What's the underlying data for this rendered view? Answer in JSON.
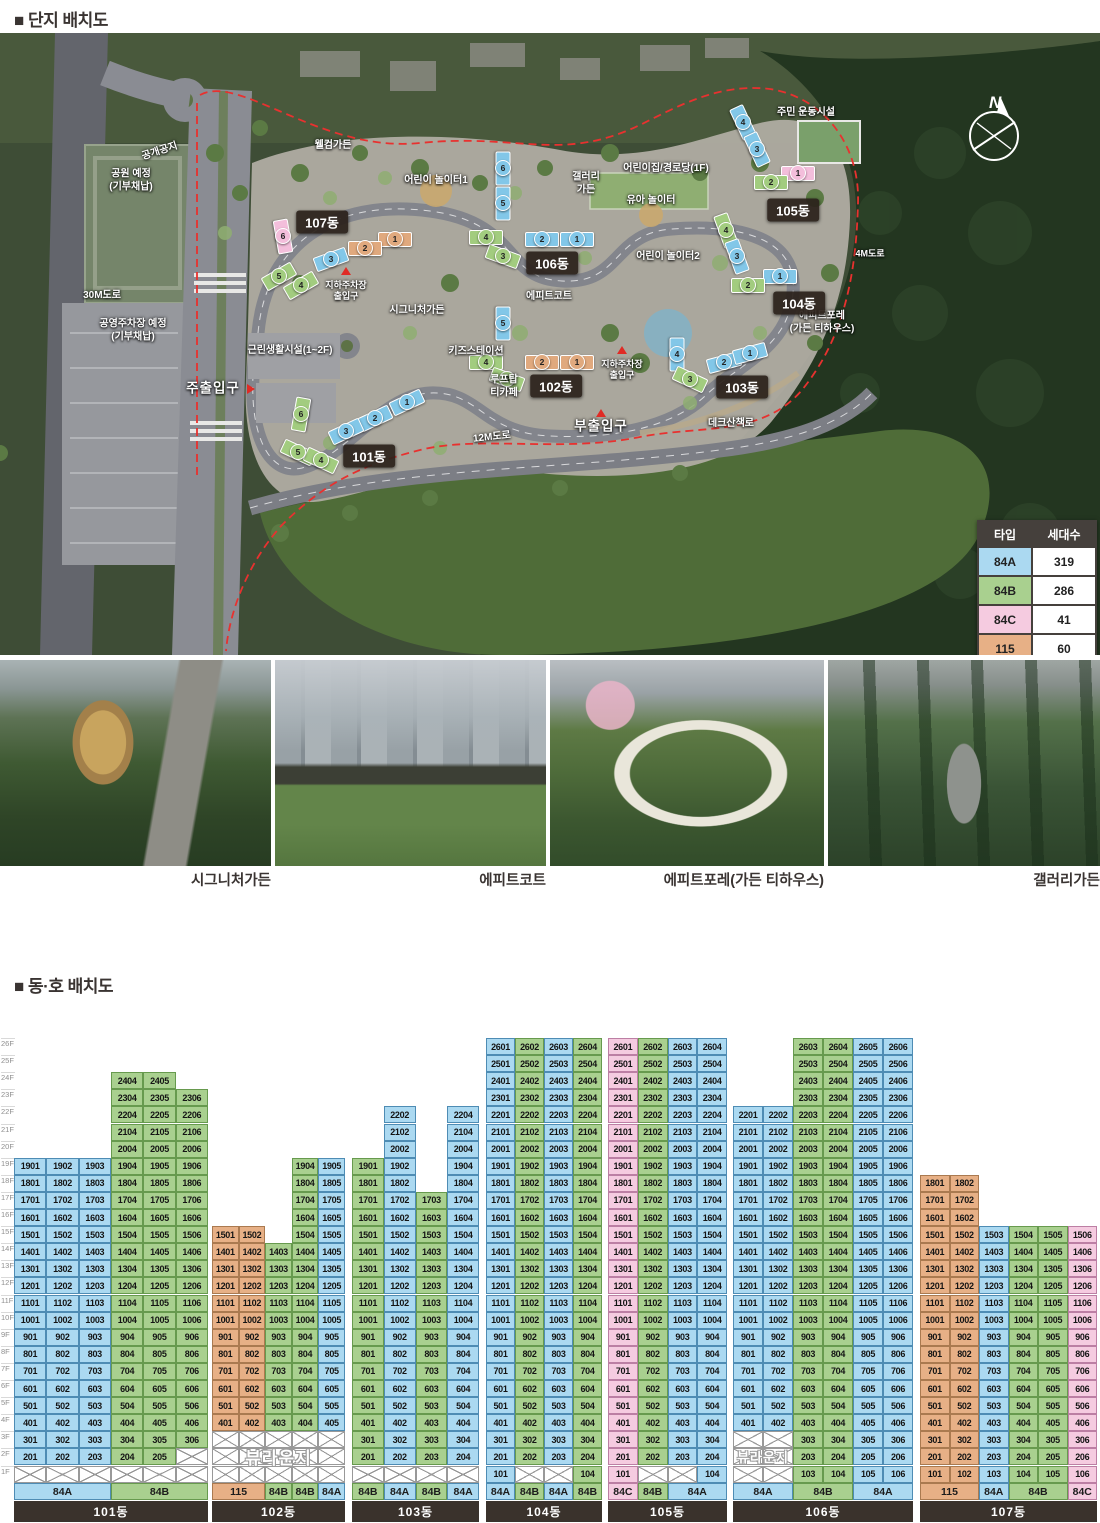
{
  "titles": {
    "site_plan": "■ 단지 배치도",
    "unit_layout": "■ 동·호 배치도"
  },
  "legend": {
    "col_type": "타입",
    "col_count": "세대수",
    "rows": [
      [
        "84A",
        "319"
      ],
      [
        "84B",
        "286"
      ],
      [
        "84C",
        "41"
      ],
      [
        "115",
        "60"
      ]
    ],
    "total": "총 706세대"
  },
  "type_colors": {
    "84A": {
      "fill": "#abd9f1",
      "edge": "#4e8cb4",
      "map": "#82c7e8"
    },
    "84B": {
      "fill": "#a9d08f",
      "edge": "#679a4e",
      "map": "#a2cc7f"
    },
    "84C": {
      "fill": "#f5cbe0",
      "edge": "#bc7fa4",
      "map": "#f3bedb"
    },
    "115": {
      "fill": "#e7b086",
      "edge": "#aa7a50",
      "map": "#e0a97e"
    }
  },
  "map": {
    "compass": "N",
    "labels": [
      {
        "t": "공개공지",
        "x": 160,
        "y": 152,
        "r": -18
      },
      {
        "t": "웰컴가든",
        "x": 333,
        "y": 146
      },
      {
        "t": "어린이 놀이터1",
        "x": 436,
        "y": 181
      },
      {
        "t": "갤러리\n가든",
        "x": 586,
        "y": 184
      },
      {
        "t": "어린이집/경로당(1F)",
        "x": 666,
        "y": 169
      },
      {
        "t": "유아 놀이터",
        "x": 651,
        "y": 201
      },
      {
        "t": "주민 운동시설",
        "x": 806,
        "y": 113
      },
      {
        "t": "4M도로",
        "x": 870,
        "y": 254,
        "s": 9
      },
      {
        "t": "어린이 놀이터2",
        "x": 668,
        "y": 257
      },
      {
        "t": "에피트코트",
        "x": 549,
        "y": 297
      },
      {
        "t": "에피트포레\n(가든 티하우스)",
        "x": 822,
        "y": 323
      },
      {
        "t": "시그니처가든",
        "x": 417,
        "y": 311
      },
      {
        "t": "지하주차장\n출입구",
        "x": 346,
        "y": 291,
        "s": 9,
        "marker": "up"
      },
      {
        "t": "지하주차장\n출입구",
        "x": 622,
        "y": 370,
        "s": 9,
        "marker": "up"
      },
      {
        "t": "공원 예정\n(기부채납)",
        "x": 131,
        "y": 181
      },
      {
        "t": "30M도로",
        "x": 102,
        "y": 296
      },
      {
        "t": "공영주차장 예정\n(기부채납)",
        "x": 133,
        "y": 331
      },
      {
        "t": "근린생활시설(1~2F)",
        "x": 290,
        "y": 351
      },
      {
        "t": "키즈스테이션",
        "x": 476,
        "y": 352
      },
      {
        "t": "루프탑\n티카페",
        "x": 504,
        "y": 387
      },
      {
        "t": "주출입구",
        "x": 213,
        "y": 389,
        "big": true,
        "marker": "right"
      },
      {
        "t": "12M도로",
        "x": 492,
        "y": 438,
        "r": -6
      },
      {
        "t": "부출입구",
        "x": 601,
        "y": 427,
        "big": true,
        "marker": "up"
      },
      {
        "t": "데크산책로",
        "x": 731,
        "y": 424
      }
    ],
    "chips": [
      {
        "t": "101동",
        "x": 369,
        "y": 456
      },
      {
        "t": "102동",
        "x": 556,
        "y": 386
      },
      {
        "t": "103동",
        "x": 742,
        "y": 387
      },
      {
        "t": "104동",
        "x": 799,
        "y": 303
      },
      {
        "t": "105동",
        "x": 793,
        "y": 210
      },
      {
        "t": "106동",
        "x": 552,
        "y": 263
      },
      {
        "t": "107동",
        "x": 322,
        "y": 222
      }
    ],
    "units": [
      {
        "n": "6",
        "t": "84B",
        "x": 300,
        "y": 413,
        "a": -80
      },
      {
        "n": "1",
        "t": "84A",
        "x": 406,
        "y": 401,
        "a": -25
      },
      {
        "n": "2",
        "t": "84A",
        "x": 374,
        "y": 417,
        "a": -25
      },
      {
        "n": "3",
        "t": "84A",
        "x": 345,
        "y": 430,
        "a": -25
      },
      {
        "n": "5",
        "t": "84B",
        "x": 297,
        "y": 451,
        "a": 25
      },
      {
        "n": "4",
        "t": "84B",
        "x": 320,
        "y": 459,
        "a": 25
      },
      {
        "n": "5",
        "t": "84A",
        "x": 502,
        "y": 322,
        "a": 90
      },
      {
        "n": "4",
        "t": "84B",
        "x": 485,
        "y": 361,
        "a": 0
      },
      {
        "n": "2",
        "t": "115",
        "x": 541,
        "y": 361,
        "a": 0
      },
      {
        "n": "1",
        "t": "115",
        "x": 576,
        "y": 361,
        "a": 0
      },
      {
        "n": "3",
        "t": "84B",
        "x": 506,
        "y": 378,
        "a": 20
      },
      {
        "n": "4",
        "t": "84A",
        "x": 676,
        "y": 353,
        "a": 90
      },
      {
        "n": "2",
        "t": "84A",
        "x": 723,
        "y": 361,
        "a": -15
      },
      {
        "n": "1",
        "t": "84A",
        "x": 749,
        "y": 352,
        "a": -15
      },
      {
        "n": "3",
        "t": "84B",
        "x": 689,
        "y": 378,
        "a": 25
      },
      {
        "n": "4",
        "t": "84B",
        "x": 725,
        "y": 229,
        "a": 70
      },
      {
        "n": "3",
        "t": "84A",
        "x": 736,
        "y": 255,
        "a": 70
      },
      {
        "n": "1",
        "t": "84A",
        "x": 779,
        "y": 275,
        "a": 0
      },
      {
        "n": "2",
        "t": "84B",
        "x": 747,
        "y": 284,
        "a": 0
      },
      {
        "n": "4",
        "t": "84A",
        "x": 742,
        "y": 121,
        "a": 65
      },
      {
        "n": "3",
        "t": "84A",
        "x": 756,
        "y": 148,
        "a": 65
      },
      {
        "n": "1",
        "t": "84C",
        "x": 797,
        "y": 172,
        "a": 0
      },
      {
        "n": "2",
        "t": "84B",
        "x": 770,
        "y": 181,
        "a": 0
      },
      {
        "n": "6",
        "t": "84A",
        "x": 502,
        "y": 167,
        "a": 90
      },
      {
        "n": "5",
        "t": "84A",
        "x": 502,
        "y": 202,
        "a": 90
      },
      {
        "n": "4",
        "t": "84B",
        "x": 485,
        "y": 236,
        "a": 0
      },
      {
        "n": "2",
        "t": "84A",
        "x": 541,
        "y": 238,
        "a": 0
      },
      {
        "n": "1",
        "t": "84A",
        "x": 576,
        "y": 238,
        "a": 0
      },
      {
        "n": "3",
        "t": "84B",
        "x": 502,
        "y": 255,
        "a": 20
      },
      {
        "n": "6",
        "t": "84C",
        "x": 282,
        "y": 235,
        "a": 80
      },
      {
        "n": "1",
        "t": "115",
        "x": 394,
        "y": 238,
        "a": 0
      },
      {
        "n": "2",
        "t": "115",
        "x": 364,
        "y": 247,
        "a": 0
      },
      {
        "n": "3",
        "t": "84A",
        "x": 330,
        "y": 258,
        "a": -20
      },
      {
        "n": "5",
        "t": "84B",
        "x": 278,
        "y": 275,
        "a": -30
      },
      {
        "n": "4",
        "t": "84B",
        "x": 300,
        "y": 284,
        "a": -30
      }
    ]
  },
  "photos": [
    {
      "caption": "시그니처가든"
    },
    {
      "caption": "에피트코트"
    },
    {
      "caption": "에피트포레(가든 티하우스)"
    },
    {
      "caption": "갤러리가든"
    }
  ],
  "grid": {
    "floors_top": 26,
    "unit_number_rule": "floor*100 + line",
    "floor_labels": [
      "26F",
      "25F",
      "24F",
      "23F",
      "22F",
      "21F",
      "20F",
      "19F",
      "18F",
      "17F",
      "16F",
      "15F",
      "14F",
      "13F",
      "12F",
      "11F",
      "10F",
      "9F",
      "8F",
      "7F",
      "6F",
      "5F",
      "4F",
      "3F",
      "2F",
      "1F"
    ],
    "lounge_label": "뷰라운지",
    "buildings": [
      {
        "name": "101동",
        "x": 14,
        "w": 194,
        "cols": [
          {
            "line": 1,
            "t": "84A",
            "f": 2,
            "to": 19
          },
          {
            "line": 2,
            "t": "84A",
            "f": 2,
            "to": 19
          },
          {
            "line": 3,
            "t": "84A",
            "f": 2,
            "to": 19
          },
          {
            "line": 4,
            "t": "84B",
            "f": 2,
            "to": 24
          },
          {
            "line": 5,
            "t": "84B",
            "f": 2,
            "to": 24
          },
          {
            "line": 6,
            "t": "84B",
            "f": 3,
            "to": 23
          }
        ],
        "xmarks": [
          {
            "fl": 1,
            "cols": [
              1,
              2,
              3,
              4,
              5,
              6
            ]
          },
          {
            "fl": 2,
            "cols": [
              6
            ]
          }
        ],
        "footer": [
          {
            "l": "84A",
            "s": 3
          },
          {
            "l": "84B",
            "s": 3
          }
        ]
      },
      {
        "name": "102동",
        "x": 212,
        "w": 133,
        "cols": [
          {
            "line": 1,
            "t": "115",
            "f": 4,
            "to": 15
          },
          {
            "line": 2,
            "t": "115",
            "f": 4,
            "to": 15
          },
          {
            "line": 3,
            "t": "84B",
            "f": 4,
            "to": 14
          },
          {
            "line": 4,
            "t": "84B",
            "f": 4,
            "to": 19
          },
          {
            "line": 5,
            "t": "84A",
            "f": 4,
            "to": 19
          }
        ],
        "lounge": {
          "f1": 1,
          "f2": 3,
          "c1": 1,
          "c2": 5
        },
        "footer": [
          {
            "l": "115",
            "s": 2
          },
          {
            "l": "84B",
            "s": 1
          },
          {
            "l": "84B",
            "s": 1
          },
          {
            "l": "84A",
            "s": 1
          }
        ]
      },
      {
        "name": "103동",
        "x": 352,
        "w": 127,
        "cols": [
          {
            "line": 1,
            "t": "84B",
            "f": 2,
            "to": 19
          },
          {
            "line": 2,
            "t": "84A",
            "f": 2,
            "to": 22
          },
          {
            "line": 3,
            "t": "84B",
            "f": 2,
            "to": 17
          },
          {
            "line": 4,
            "t": "84A",
            "f": 2,
            "to": 22
          }
        ],
        "xmarks": [
          {
            "fl": 1,
            "cols": [
              1,
              2,
              3,
              4
            ]
          }
        ],
        "footer": [
          {
            "l": "84B",
            "s": 1
          },
          {
            "l": "84A",
            "s": 1
          },
          {
            "l": "84B",
            "s": 1
          },
          {
            "l": "84A",
            "s": 1
          }
        ]
      },
      {
        "name": "104동",
        "x": 486,
        "w": 116,
        "cols": [
          {
            "line": 1,
            "t": "84A",
            "f": 1,
            "to": 26
          },
          {
            "line": 2,
            "t": "84B",
            "f": 2,
            "to": 26
          },
          {
            "line": 3,
            "t": "84A",
            "f": 2,
            "to": 26
          },
          {
            "line": 4,
            "t": "84B",
            "f": 1,
            "to": 26
          }
        ],
        "xmarks": [
          {
            "fl": 1,
            "cols": [
              2,
              3
            ]
          }
        ],
        "footer": [
          {
            "l": "84A",
            "s": 1
          },
          {
            "l": "84B",
            "s": 1
          },
          {
            "l": "84A",
            "s": 1
          },
          {
            "l": "84B",
            "s": 1
          }
        ]
      },
      {
        "name": "105동",
        "x": 608,
        "w": 119,
        "cols": [
          {
            "line": 1,
            "t": "84C",
            "f": 1,
            "to": 26
          },
          {
            "line": 2,
            "t": "84B",
            "f": 2,
            "to": 26
          },
          {
            "line": 3,
            "t": "84A",
            "f": 2,
            "to": 26
          },
          {
            "line": 4,
            "t": "84A",
            "f": 1,
            "to": 26
          }
        ],
        "xmarks": [
          {
            "fl": 1,
            "cols": [
              2,
              3
            ]
          }
        ],
        "footer": [
          {
            "l": "84C",
            "s": 1
          },
          {
            "l": "84B",
            "s": 1
          },
          {
            "l": "84A",
            "s": 2
          }
        ]
      },
      {
        "name": "106동",
        "x": 733,
        "w": 180,
        "cols": [
          {
            "line": 1,
            "t": "84A",
            "f": 4,
            "to": 22
          },
          {
            "line": 2,
            "t": "84A",
            "f": 4,
            "to": 22
          },
          {
            "line": 3,
            "t": "84B",
            "f": 1,
            "to": 26
          },
          {
            "line": 4,
            "t": "84B",
            "f": 1,
            "to": 26
          },
          {
            "line": 5,
            "t": "84A",
            "f": 1,
            "to": 26
          },
          {
            "line": 6,
            "t": "84A",
            "f": 1,
            "to": 26
          }
        ],
        "lounge": {
          "f1": 1,
          "f2": 3,
          "c1": 1,
          "c2": 2
        },
        "footer": [
          {
            "l": "84A",
            "s": 2
          },
          {
            "l": "84B",
            "s": 2
          },
          {
            "l": "84A",
            "s": 2
          }
        ]
      },
      {
        "name": "107동",
        "x": 920,
        "w": 177,
        "cols": [
          {
            "line": 1,
            "t": "115",
            "f": 1,
            "to": 18
          },
          {
            "line": 2,
            "t": "115",
            "f": 1,
            "to": 18
          },
          {
            "line": 3,
            "t": "84A",
            "f": 1,
            "to": 15
          },
          {
            "line": 4,
            "t": "84B",
            "f": 1,
            "to": 15
          },
          {
            "line": 5,
            "t": "84B",
            "f": 1,
            "to": 15
          },
          {
            "line": 6,
            "t": "84C",
            "f": 1,
            "to": 15
          }
        ],
        "footer": [
          {
            "l": "115",
            "s": 2
          },
          {
            "l": "84A",
            "s": 1
          },
          {
            "l": "84B",
            "s": 2
          },
          {
            "l": "84C",
            "s": 1
          }
        ]
      }
    ]
  }
}
